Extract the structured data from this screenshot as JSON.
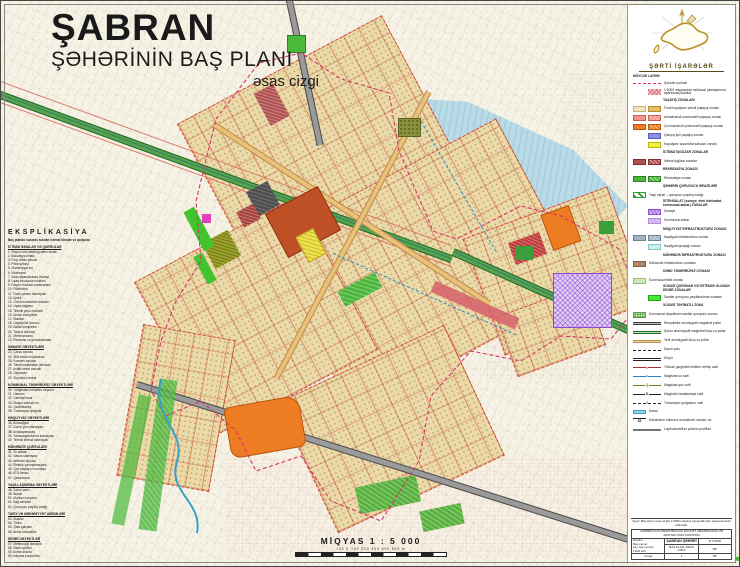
{
  "palette": {
    "paper": "#f6f3e6",
    "city_block_tan": "#ecd9a8",
    "water_blue": "#b9dbe7",
    "road_green": "#5aa24b",
    "road_gray": "#9a9a9a",
    "public_terracotta": "#bf4f24",
    "orange_zone": "#ee7c22",
    "recreation_green": "#4cb83c",
    "industry_purple": "#8a4fd0",
    "boundary_magenta": "#d6336c",
    "legend_gold": "#b8902a"
  },
  "title": {
    "city": "ŞABRAN",
    "line2": "ŞƏHƏRİNİN BAŞ PLANI",
    "line3": "əsas cizgi"
  },
  "scale": {
    "label": "MİQYAS 1 : 5 000",
    "ticks": "100   0   100   200   300   400   500 m"
  },
  "explication": {
    "title": "EKSPLİKASİYA",
    "subtitle": "Baş planda nəzərdə tutulan ictimai binalar və qurğular",
    "sections": [
      {
        "h": "İCTİMAİ BİNALAR VƏ QURĞULAR",
        "items": "1. Rayon icra hakimiyyətinin binası\n2. Bələdiyyə binası\n3. Poçt-rabitə şöbəsi\n4. Polis şöbəsi\n5. Mədəniyyət evi\n6. Kitabxana\n7. Tarix-diyarşünaslıq muzeyi\n8. Uşaq incəsənət məktəbi\n9. Rayon mərkəzi xəstəxanası\n10. Poliklinika\n11. Təcili yardım stansiyası\n12. Aptek\n13. Orta ümumtəhsil məktəbi\n14. Uşaq bağçası\n15. Texniki peşə məktəbi\n16. İdman kompleksi\n17. Stadion\n18. Üzgüçülük hovuzu\n19. Bazar kompleksi\n20. Ticarət mərkəzi\n21. Mehmanxana\n22. Restoran və yeməkxanalar"
      },
      {
        "h": "SƏNAYE OBYEKTLƏRİ",
        "items": "23. Çörək zavodu\n24. Süd emalı müəssisəsi\n25. Konserv zavodu\n26. Tikinti materialları istehsalı\n27. Asfalt-beton zavodu\n28. Dəyirman\n29. Soyuducu anbar"
      },
      {
        "h": "KOMMUNAL TƏSƏRRÜFAT OBYEKTLƏRİ",
        "items": "30. Yanğından mühafizə deposu\n31. Hamam\n32. Camaşırxana\n33. Məişət xidməti evi\n34. Qəbiristanlıq\n35. Təmizləyici qurğular"
      },
      {
        "h": "NƏQLİYYAT OBYEKTLƏRİ",
        "items": "36. Avtovağzal\n37. Dəmir yolu stansiyası\n38. Avtodayanacaq\n39. Yanacaqdoldurma stansiyası\n40. Texniki xidmət stansiyası"
      },
      {
        "h": "MÜHƏNDİS QURĞULARI",
        "items": "41. Su anbarı\n42. Nasos stansiyası\n43. Artezian quyusu\n44. Elektrik yarımstansiyası\n45. Qaz paylayıcı məntəqə\n46. ATS binası\n47. Qazanxana"
      },
      {
        "h": "YAŞILLAŞDIRMA OBYEKTLƏRİ",
        "items": "48. Şəhər parkı\n49. Bulvar\n50. Mərkəzi meydan\n51. Bağ sahələri\n52. Qoruyucu yaşıllıq zolağı"
      },
      {
        "h": "TARİX VƏ MƏDƏNİYYƏT ABİDƏLƏRİ",
        "items": "53. Məscid\n54. Türbə\n55. Qala qalıqları\n56. Abidə kompleksi"
      },
      {
        "h": "DİGƏR OBYEKTLƏR",
        "items": "57. Meteoroloji stansiya\n58. Radio qülləsi\n59. Anbar ərazisi\n60. İstixana təsərrüfatı"
      }
    ]
  },
  "legend": {
    "title": "ŞƏRTİ İŞARƏLƏR",
    "col_existing": "MÖVCUD",
    "col_project": "LAYİHƏ",
    "rows": [
      {
        "m": "reddash",
        "l": "reddash",
        "t": "Şəhərin sərhədi"
      },
      {
        "l": "pinkh",
        "t": "1:5000 miqyasında müfəssəl planlaşdırma aparılacaq ərazilər"
      },
      {
        "k": "h",
        "t": "YAŞAYIŞ ZONALARI"
      },
      {
        "m": "cream",
        "l": "tan",
        "t": "Fərdi həyətyanı sahəli yaşayış zonası"
      },
      {
        "m": "salmon",
        "l": "salmonh",
        "t": "Azmərtəbəli çoxmənzilli yaşayış zonası"
      },
      {
        "m": "orange",
        "l": "orangeh",
        "t": "Çoxmərtəbəli çoxmənzilli yaşayış zonası"
      },
      {
        "l": "blue",
        "t": "Qarışıq tipli yaşayış zonası"
      },
      {
        "l": "yellow",
        "t": "Həyətyanı təsərrüfat sahələri zonası"
      },
      {
        "k": "h",
        "t": "İCTİMAİ İŞGÜZAR ZONALAR"
      },
      {
        "m": "dred",
        "l": "dredh",
        "t": "İctimai işgüzar zonalar"
      },
      {
        "k": "h",
        "t": "REKREASİYA ZONASI"
      },
      {
        "m": "green",
        "l": "greenh",
        "t": "Rekreasiya zonası"
      },
      {
        "k": "h",
        "t": "ŞƏHƏRİN QORUYUCU ƏRAZİLƏRİ"
      },
      {
        "m": "gstripe",
        "l": "hide",
        "t": "Yaşıl ekran – qoruyucu yaşıllıq zolağı"
      },
      {
        "k": "h",
        "t": "İSTEHSALAT (sənaye, elmi istehsalat, kommunal-anbar) ZONALAR"
      },
      {
        "l": "purpleh",
        "t": "Sənaye"
      },
      {
        "l": "lilach",
        "t": "Kommunal-anbar"
      },
      {
        "k": "h",
        "t": "NƏQLİYYAT İNFRASTRUKTURU ZONASI"
      },
      {
        "m": "bgray",
        "l": "bgrayh",
        "t": "Nəqliyyat infrastrukturu zonası"
      },
      {
        "l": "cyan",
        "t": "Nəqliyyat qovşağı zonası"
      },
      {
        "k": "h",
        "t": "MÜHƏNDİS İNFRASTRUKTURU ZONASI"
      },
      {
        "m": "brown",
        "l": "hide",
        "t": "Mühəndis infrastrukturu zonaları"
      },
      {
        "k": "h",
        "t": "KƏND TƏSƏRRÜFATI ZONASI"
      },
      {
        "m": "pgreen",
        "l": "hide",
        "t": "Kənd təsərrüfatı zonası"
      },
      {
        "k": "h",
        "t": "XÜSUSİ QORUNAN VƏ İSTİFADƏ OLUNAN DİGƏR ZONALAR"
      },
      {
        "l": "bgreen",
        "t": "Sanitar qoruyucu yaşıllandırma zonaları"
      },
      {
        "k": "h",
        "t": "XÜSUSİ TƏYİNATLI ZONA"
      },
      {
        "m": "gdot",
        "l": "hide",
        "t": "Kommunal obyektlərin sanitar qoruyucu zonası"
      },
      {
        "m": "lngray",
        "l": "hide",
        "t": "Respublika əhəmiyyətli magistral yollar"
      },
      {
        "m": "lngreen",
        "l": "hide",
        "t": "Şəhər əhəmiyyətli magistral küçə və yollar"
      },
      {
        "m": "lntan",
        "l": "hide",
        "t": "Yerli əhəmiyyətli küçə və yollar"
      },
      {
        "m": "lndash",
        "l": "hide",
        "t": "Dəmir yolu"
      },
      {
        "m": "lnbridge",
        "l": "hide",
        "t": "Körpü"
      },
      {
        "m": "lnelec",
        "l": "hide",
        "st": "e",
        "t": "Yüksək gərginlikli elektrik verilişi xətti"
      },
      {
        "m": "lnwater",
        "l": "hide",
        "st": "s",
        "t": "Magistral su xətti"
      },
      {
        "m": "lngas",
        "l": "hide",
        "st": "Q",
        "t": "Magistral qaz xətti"
      },
      {
        "m": "lnkan",
        "l": "hide",
        "st": "K",
        "t": "Magistral kanalizasiya xətti"
      },
      {
        "m": "lnf",
        "l": "hide",
        "st": "f",
        "t": "Təmizləyici qurğuların xətti"
      },
      {
        "m": "canal",
        "l": "hide",
        "t": "Kanal"
      },
      {
        "m": "num",
        "l": "hide",
        "st": "83",
        "t": "Məhəllənin nömrəsi; məhəllənin sahəsi, ha"
      },
      {
        "m": "lnprof",
        "l": "hide",
        "t": "Layihələndirilən yolların profilləri"
      }
    ]
  },
  "title_block": {
    "note": "Qeyd: Baş planın əsas cizgisi 1:5000 miqyaslı topoqrafik plan əsasında tərtib edilmişdir.",
    "org": "AZƏRBAYCAN RESPUBLİKASI DÖVLƏT ŞƏHƏRSALMA VƏ ARXİTEKTURA KOMİTƏSİ",
    "project": "ŞABRAN ŞƏHƏRİ",
    "drawing": "BAŞ PLAN. ƏSAS CİZGİ",
    "scale": "M 1:5000",
    "stage": "BP",
    "sheet_label": "Vərəq",
    "sheet_no": "1",
    "roles": "Direktor\nBaş memar\nLay. baş memarı\nTərtib etdi"
  }
}
